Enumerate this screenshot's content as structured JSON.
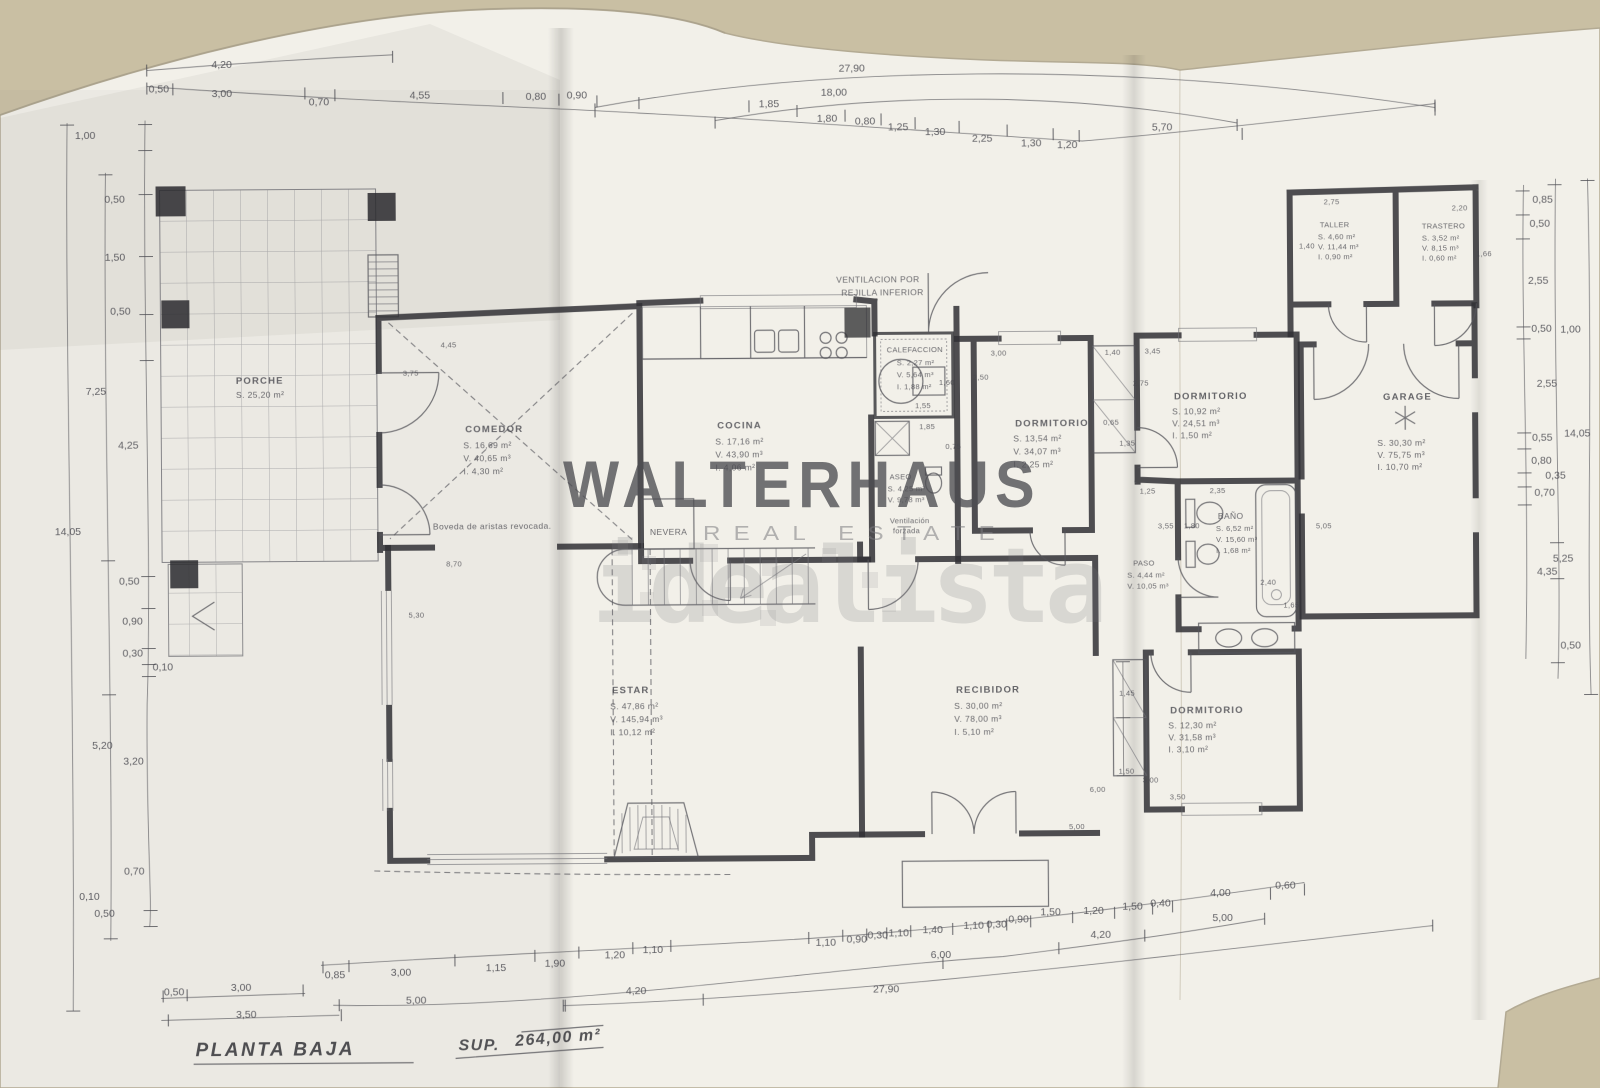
{
  "photo": {
    "surface_color": "#c9bfa3",
    "paper_color": "#f2f0e9",
    "ink_color": "#2e2e33",
    "watermark_gray": "#4e4e52"
  },
  "watermark": {
    "brand": "WALTERHAUS",
    "tagline": "REAL ESTATE",
    "portal": "idealista"
  },
  "plan_title": {
    "name": "PLANTA BAJA",
    "sup_label": "SUP.",
    "area": "264,00 m²"
  },
  "annotations": {
    "ventilation_line1": "VENTILACION POR",
    "ventilation_line2": "REJILLA INFERIOR",
    "vault_note": "Boveda de aristas revocada.",
    "fridge": "NEVERA",
    "forced_vent_line1": "Ventilación",
    "forced_vent_line2": "forzada"
  },
  "rooms": {
    "porche": {
      "name": "PORCHE",
      "s": "S. 25,20 m²"
    },
    "comedor": {
      "name": "COMEDOR",
      "s": "S. 16,69 m²",
      "v": "V. 40,65 m³",
      "i": "I. 4,30 m²"
    },
    "cocina": {
      "name": "COCINA",
      "s": "S. 17,16 m²",
      "v": "V. 43,90 m³",
      "i": "I. 4,06 m²"
    },
    "calefaccion": {
      "name": "CALEFACCION",
      "s": "S. 2,27 m²",
      "v": "V. 5,64 m³",
      "i": "I. 1,88 m²"
    },
    "aseo": {
      "name": "ASEO",
      "s": "S. 4,25 m²",
      "v": "V. 9,78 m³"
    },
    "dormitorio1": {
      "name": "DORMITORIO",
      "s": "S. 13,54 m²",
      "v": "V. 34,07 m³",
      "i": "I. 2,25 m²"
    },
    "dormitorio2": {
      "name": "DORMITORIO",
      "s": "S. 10,92 m²",
      "v": "V. 24,51 m³",
      "i": "I. 1,50 m²"
    },
    "dormitorio3": {
      "name": "DORMITORIO",
      "s": "S. 12,30 m²",
      "v": "V. 31,58 m³",
      "i": "I. 3,10 m²"
    },
    "bano": {
      "name": "BAÑO",
      "s": "S. 6,52 m²",
      "v": "V. 15,60 m³",
      "i": "I. 1,68 m²"
    },
    "paso": {
      "name": "PASO",
      "s": "S. 4,44 m²",
      "v": "V. 10,05 m³"
    },
    "recibidor": {
      "name": "RECIBIDOR",
      "s": "S. 30,00 m²",
      "v": "V. 78,00 m³",
      "i": "I. 5,10 m²"
    },
    "estar": {
      "name": "ESTAR",
      "s": "S. 47,86 m²",
      "v": "V. 145,94 m³",
      "i": "I. 10,12 m²"
    },
    "garage": {
      "name": "GARAGE",
      "s": "S. 30,30 m²",
      "v": "V. 75,75 m³",
      "i": "I. 10,70 m²"
    },
    "taller": {
      "name": "TALLER",
      "s": "S. 4,60 m²",
      "v": "V. 11,44 m³",
      "i": "I. 0,90 m²"
    },
    "trastero": {
      "name": "TRASTERO",
      "s": "S. 3,52 m²",
      "v": "V. 8,15 m³",
      "i": "I. 0,60 m²"
    }
  },
  "dims": {
    "top_totals": {
      "a": "4,20",
      "b": "27,90",
      "c": "18,00"
    },
    "top_row": [
      "0,50",
      "3,00",
      "0,70",
      "4,55",
      "0,80",
      "0,90",
      "1,85",
      "1,80",
      "0,80",
      "1,25",
      "1,30",
      "2,25",
      "1,30",
      "1,20",
      "5,70"
    ],
    "left_col": [
      "1,00",
      "0,50",
      "1,50",
      "0,50",
      "7,25",
      "4,25",
      "14,05",
      "0,50",
      "0,90",
      "0,30",
      "0,10",
      "5,20",
      "3,20",
      "0,70",
      "0,10",
      "0,50"
    ],
    "right_col": [
      "0,85",
      "0,50",
      "2,55",
      "0,50",
      "1,00",
      "2,55",
      "0,55",
      "0,80",
      "0,35",
      "0,70",
      "14,05",
      "5,25",
      "4,35",
      "0,50"
    ],
    "bottom_row1": [
      "0,85",
      "3,00",
      "1,15",
      "1,90",
      "1,20",
      "1,10",
      "1,10",
      "0,90",
      "0,30",
      "1,10",
      "1,40",
      "1,10",
      "0,30",
      "0,90",
      "1,50",
      "1,20",
      "1,50",
      "0,40",
      "4,00",
      "0,60"
    ],
    "bottom_row2": [
      "0,50",
      "3,00",
      "5,00",
      "6,00",
      "4,20",
      "5,00"
    ],
    "bottom_row3": [
      "3,50",
      "4,20",
      "27,90"
    ],
    "inner": [
      "4,45",
      "3,75",
      "8,70",
      "5,30",
      "1,55",
      "1,60",
      "1,85",
      "0,75",
      "3,00",
      "2,50",
      "1,40",
      "3,45",
      "2,75",
      "1,35",
      "0,65",
      "1,25",
      "2,35",
      "3,55",
      "1,80",
      "2,40",
      "1,65",
      "1,45",
      "1,50",
      "3,00",
      "3,50",
      "6,00",
      "5,00",
      "2,75",
      "1,40",
      "2,20",
      "1,66",
      "5,05"
    ]
  }
}
